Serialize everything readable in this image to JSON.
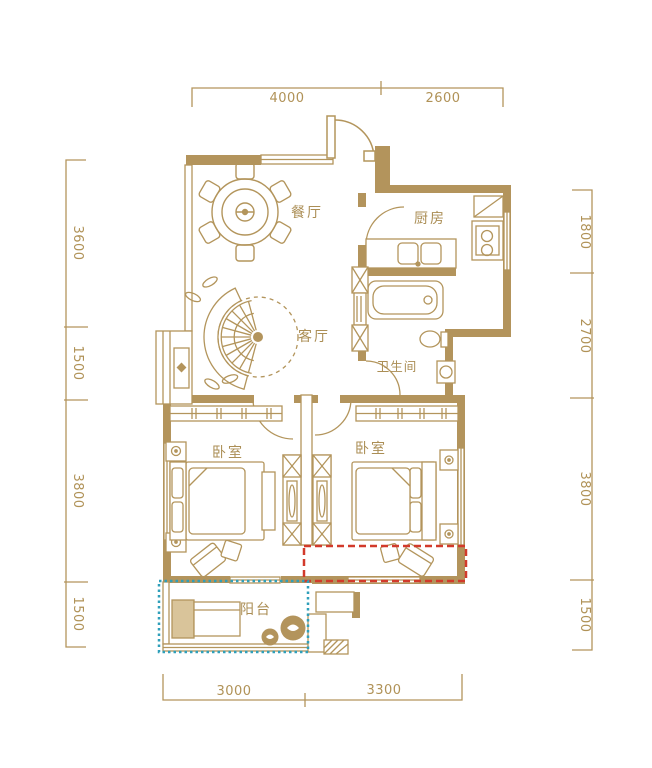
{
  "title": "apartment-floor-plan",
  "colors": {
    "wall": "#b3945c",
    "line": "#b3955c",
    "label_text": "#ab8e55",
    "red_highlight": "#d23a2b",
    "blue_highlight": "#2f9fba",
    "background": "#ffffff"
  },
  "rooms": {
    "dining": {
      "label": "餐厅"
    },
    "kitchen": {
      "label": "厨房"
    },
    "living": {
      "label": "客厅"
    },
    "bathroom": {
      "label": "卫生间"
    },
    "bedroom_left": {
      "label": "卧室"
    },
    "bedroom_right": {
      "label": "卧室"
    },
    "balcony": {
      "label": "阳台"
    }
  },
  "dimensions": {
    "top": [
      "4000",
      "2600"
    ],
    "bottom": [
      "3000",
      "3300"
    ],
    "left": [
      "3600",
      "1500",
      "3800",
      "1500"
    ],
    "right": [
      "1800",
      "2700",
      "3800",
      "1500"
    ]
  },
  "highlights": {
    "red": {
      "style": "dashed",
      "color": "#d23a2b"
    },
    "blue": {
      "style": "dotted",
      "color": "#2f9fba"
    }
  }
}
